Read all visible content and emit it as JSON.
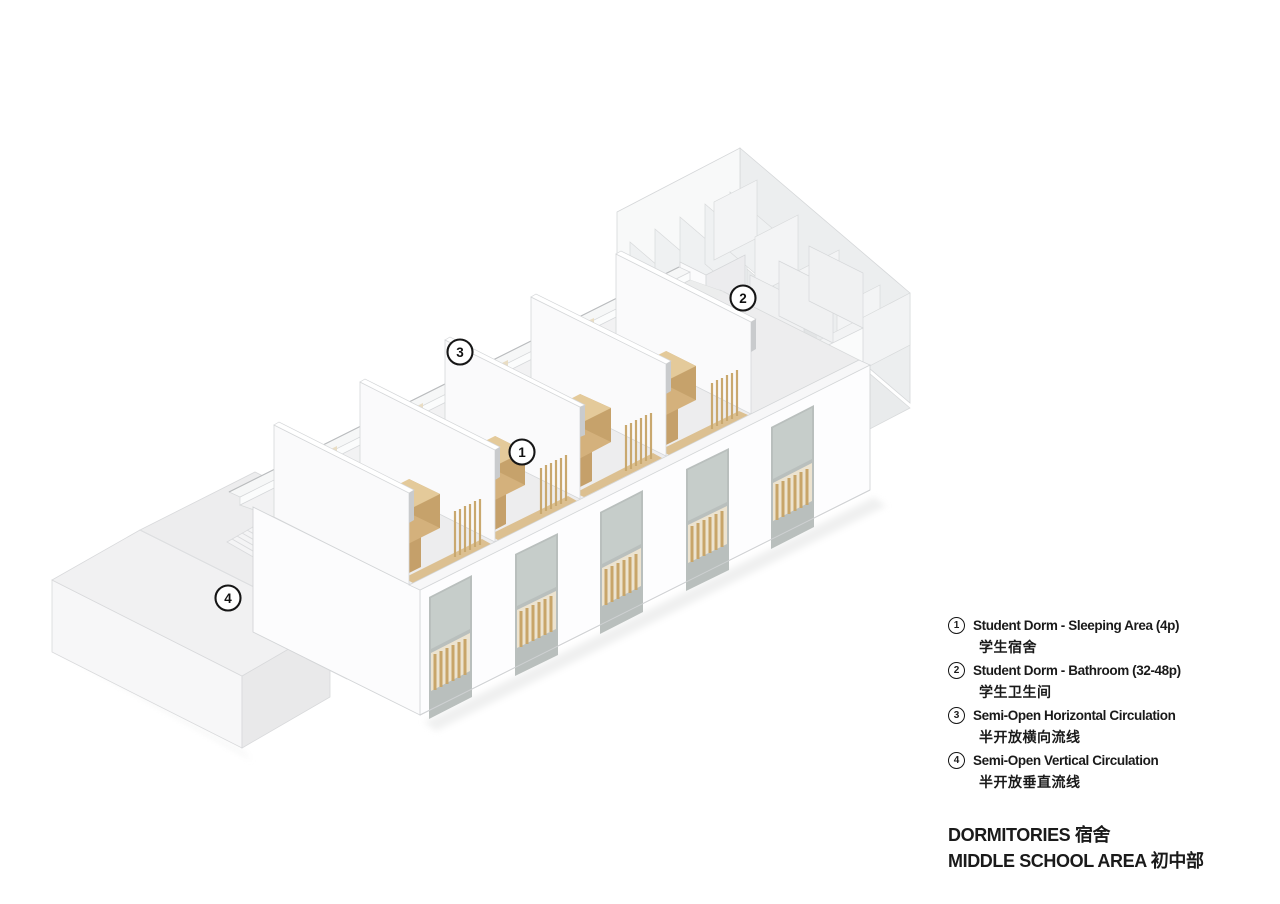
{
  "drawing": {
    "description": "Axonometric cutaway diagram of a middle-school dormitory building",
    "markers": [
      {
        "num": "1"
      },
      {
        "num": "2"
      },
      {
        "num": "3"
      },
      {
        "num": "4"
      }
    ]
  },
  "legend": {
    "items": [
      {
        "num": "1",
        "en": "Student Dorm - Sleeping Area (4p)",
        "zh": "学生宿舍"
      },
      {
        "num": "2",
        "en": "Student Dorm - Bathroom (32-48p)",
        "zh": "学生卫生间"
      },
      {
        "num": "3",
        "en": "Semi-Open Horizontal Circulation",
        "zh": "半开放横向流线"
      },
      {
        "num": "4",
        "en": "Semi-Open Vertical Circulation",
        "zh": "半开放垂直流线"
      }
    ]
  },
  "footer": {
    "line1": "DORMITORIES 宿舍",
    "line2": "MIDDLE SCHOOL AREA 初中部"
  },
  "colors": {
    "wood": "#d9b780",
    "woodLight": "#e7cf9f",
    "woodDark": "#c7a269",
    "surface": "#f0f1f2",
    "floor": "#ededee",
    "glass": "#c6cdca",
    "ink": "#1a1a1a",
    "line": "#d5d6d8"
  }
}
